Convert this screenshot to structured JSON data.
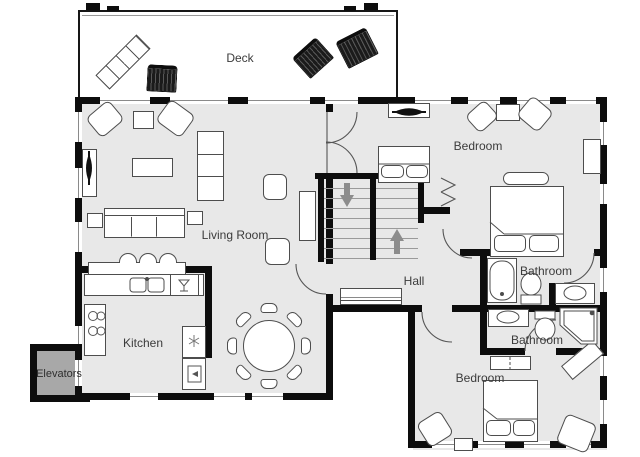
{
  "title": "Residential floor plan",
  "rooms": {
    "deck": {
      "label": "Deck"
    },
    "living_room": {
      "label": "Living Room"
    },
    "kitchen": {
      "label": "Kitchen"
    },
    "hall": {
      "label": "Hall"
    },
    "bedroom_top": {
      "label": "Bedroom"
    },
    "bedroom_bottom": {
      "label": "Bedroom"
    },
    "bathroom_top": {
      "label": "Bathroom"
    },
    "bathroom_bottom": {
      "label": "Bathroom"
    },
    "elevators": {
      "label": "Elevators"
    }
  },
  "colors": {
    "wall": "#0d0d0d",
    "floor": "#e8e8e8",
    "deck_floor": "#ffffff",
    "elevator_floor": "#a8a8a8",
    "furniture_outline": "#4d4d4d",
    "stair_arrow": "#8c8c8c",
    "label_text": "#3b3b3b",
    "window_line": "#8a8a8a"
  },
  "icons": {
    "stairs_down_arrow": "▼",
    "stairs_up_arrow": "▲",
    "fridge_snowflake": "❄",
    "dishwasher_glass": "glass",
    "tv": "screen"
  }
}
